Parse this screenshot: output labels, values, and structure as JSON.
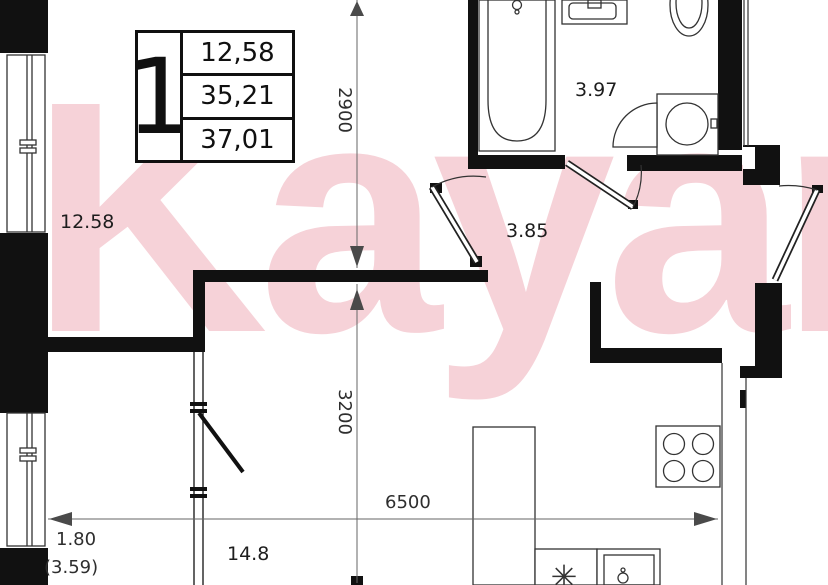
{
  "watermark": {
    "text": "Kayan",
    "color": "#f6d2d8"
  },
  "info_box": {
    "room_count": "1",
    "area_rows": [
      "12,58",
      "35,21",
      "37,01"
    ]
  },
  "rooms": {
    "bedroom": "12.58",
    "bathroom": "3.97",
    "hallway": "3.85",
    "kitchen_living": "14.8"
  },
  "dims": {
    "top_height": "2900",
    "bottom_height": "3200",
    "width": "6500",
    "balcony_width": "1.80",
    "balcony_area": "(3.59)"
  },
  "colors": {
    "wall_black": "#111111",
    "thin_line": "#333333",
    "dim_gray": "#4a4a4a",
    "watermark_pink": "#f6d2d8"
  }
}
